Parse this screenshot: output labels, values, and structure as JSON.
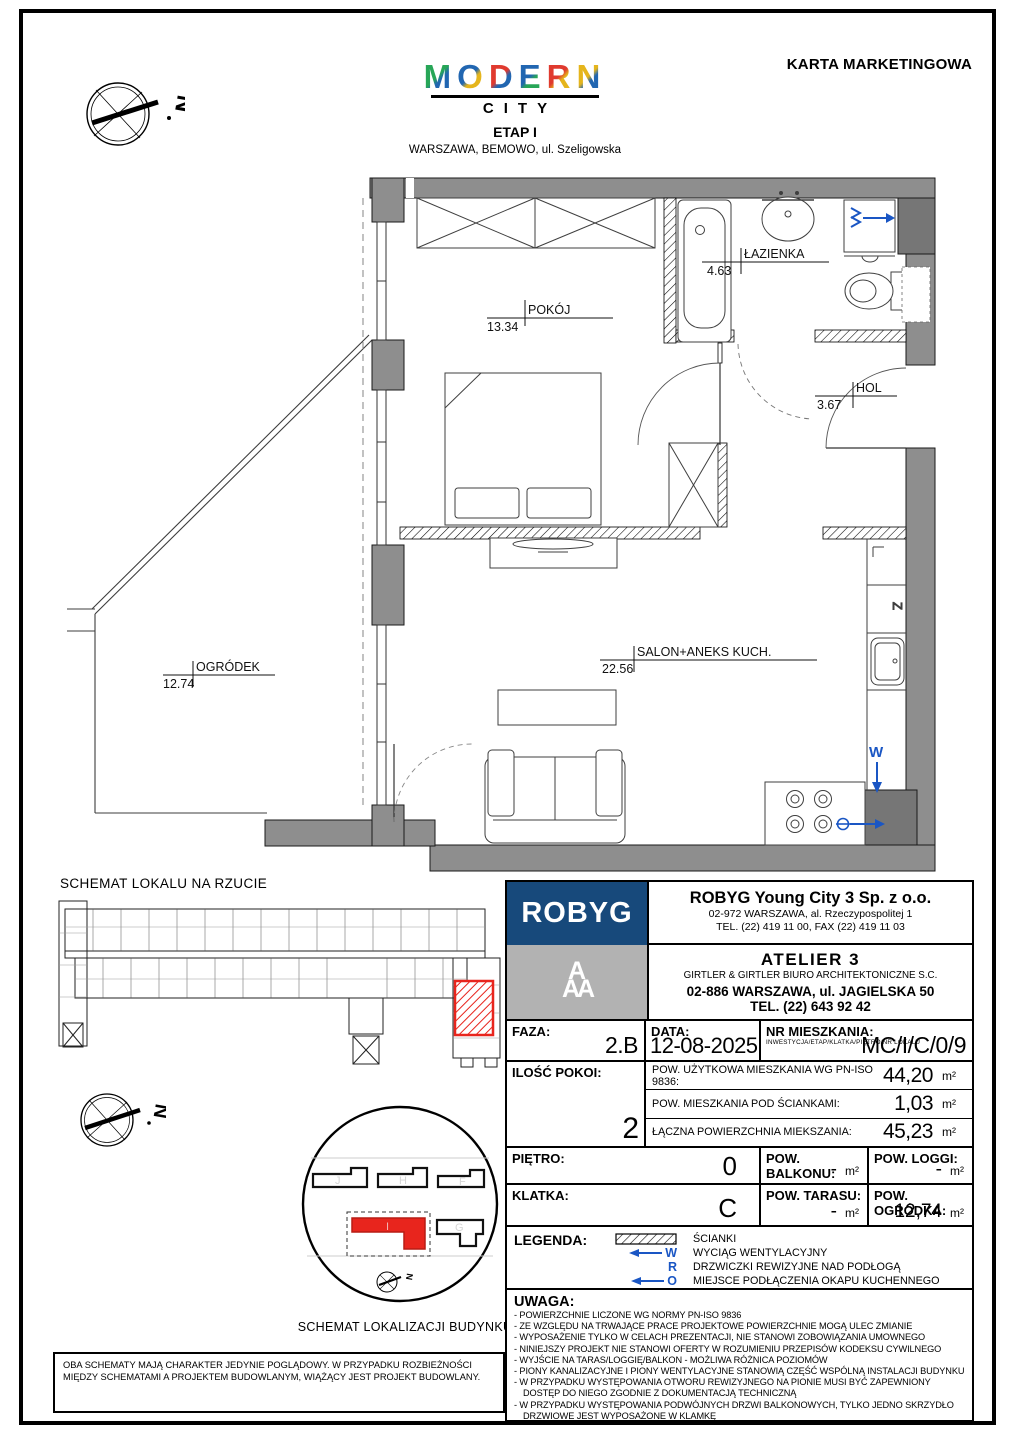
{
  "page": {
    "karta_title": "KARTA MARKETINGOWA"
  },
  "header": {
    "logo_word": "MODERN",
    "logo_sub": "CITY",
    "etap": "ETAP I",
    "address": "WARSZAWA, BEMOWO, ul. Szeligowska"
  },
  "plan": {
    "rooms": {
      "pokoj": {
        "name": "POKÓJ",
        "area": "13.34"
      },
      "lazienka": {
        "name": "ŁAZIENKA",
        "area": "4.63"
      },
      "hol": {
        "name": "HOL",
        "area": "3.67"
      },
      "salon": {
        "name": "SALON+ANEKS KUCH.",
        "area": "22.56"
      },
      "ogrodek": {
        "name": "OGRÓDEK",
        "area": "12.74"
      }
    },
    "symbols": {
      "vent": "W",
      "hood": "O",
      "dishwasher": "Z",
      "fridge": "L",
      "north": "N"
    }
  },
  "schemat_lokalu": {
    "title": "SCHEMAT LOKALU NA RZUCIE"
  },
  "schemat_lokalizacji": {
    "title": "SCHEMAT LOKALIZACJI BUDYNKU",
    "buildings": [
      "J",
      "H",
      "F",
      "I",
      "G"
    ]
  },
  "developer": {
    "logo": "ROBYG",
    "logo_aaa": "A",
    "company": "ROBYG Young City 3 Sp. z o.o.",
    "address": "02-972 WARSZAWA, al. Rzeczypospolitej 1",
    "phone": "TEL. (22) 419 11 00, FAX (22) 419 11 03"
  },
  "architect": {
    "name": "ATELIER 3",
    "studio": "GIRTLER & GIRTLER BIURO ARCHITEKTONICZNE S.C.",
    "address": "02-886 WARSZAWA, ul. JAGIELSKA 50",
    "phone": "TEL. (22) 643 92 42"
  },
  "table": {
    "faza": {
      "label": "FAZA:",
      "value": "2.B"
    },
    "data": {
      "label": "DATA:",
      "value": "12-08-2025"
    },
    "nr": {
      "label": "NR MIESZKANIA:",
      "sub": "INWESTYCJA/ETAP/KLATKA/PIĘTRO/NR LOKALU",
      "value": "MC/I/C/0/9"
    },
    "pokoi": {
      "label": "ILOŚĆ POKOI:",
      "value": "2"
    },
    "areas": [
      {
        "label": "POW. UŻYTKOWA MIESZKANIA WG PN-ISO 9836:",
        "value": "44,20",
        "unit": "m²"
      },
      {
        "label": "POW. MIESZKANIA POD ŚCIANKAMI:",
        "value": "1,03",
        "unit": "m²"
      },
      {
        "label": "ŁĄCZNA POWIERZCHNIA MIEKSZANIA:",
        "value": "45,23",
        "unit": "m²"
      }
    ],
    "pietro": {
      "label": "PIĘTRO:",
      "value": "0"
    },
    "balkon": {
      "label": "POW. BALKONU:",
      "value": "-",
      "unit": "m²"
    },
    "loggi": {
      "label": "POW. LOGGI:",
      "value": "-",
      "unit": "m²"
    },
    "klatka": {
      "label": "KLATKA:",
      "value": "C"
    },
    "taras": {
      "label": "POW. TARASU:",
      "value": "-",
      "unit": "m²"
    },
    "ogrodek_pow": {
      "label": "POW. OGRÓDKA:",
      "value": "12,74",
      "unit": "m²"
    }
  },
  "legenda": {
    "title": "LEGENDA:",
    "items": [
      {
        "symbol": "hatch",
        "text": "ŚCIANKI"
      },
      {
        "symbol": "W",
        "text": "WYCIĄG WENTYLACYJNY"
      },
      {
        "symbol": "R",
        "text": "DRZWICZKI REWIZYJNE NAD PODŁOGĄ"
      },
      {
        "symbol": "O",
        "text": "MIEJSCE PODŁĄCZENIA OKAPU KUCHENNEGO"
      }
    ]
  },
  "uwaga": {
    "title": "UWAGA:",
    "notes": [
      "- POWIERZCHNIE LICZONE WG NORMY PN-ISO 9836",
      "- ZE WZGLĘDU NA TRWAJĄCE PRACE PROJEKTOWE POWIERZCHNIE MOGĄ ULEC ZMIANIE",
      "- WYPOSAŻENIE TYLKO W CELACH PREZENTACJI, NIE STANOWI ZOBOWIĄZANIA UMOWNEGO",
      "- NINIEJSZY PROJEKT NIE STANOWI OFERTY W ROZUMIENIU PRZEPISÓW KODEKSU CYWILNEGO",
      "- WYJŚCIE NA TARAS/LOGGIĘ/BALKON - MOŻLIWA RÓŻNICA POZIOMÓW",
      "- PIONY KANALIZACYJNE I PIONY WENTYLACYJNE STANOWIĄ CZĘŚĆ WSPÓLNĄ INSTALACJI BUDYNKU",
      "- W PRZYPADKU WYSTĘPOWANIA OTWORU REWIZYJNEGO NA PIONIE MUSI BYĆ ZAPEWNIONY DOSTĘP DO NIEGO ZGODNIE Z DOKUMENTACJĄ TECHNICZNĄ",
      "- W PRZYPADKU WYSTĘPOWANIA PODWÓJNYCH DRZWI BALKONOWYCH, TYLKO JEDNO SKRZYDŁO DRZWIOWE JEST WYPOSAŻONE W KLAMKĘ"
    ]
  },
  "footer": {
    "text": "OBA SCHEMATY MAJĄ CHARAKTER JEDYNIE POGLĄDOWY. W PRZYPADKU ROZBIEŻNOŚCI MIĘDZY SCHEMATAMI A PROJEKTEM BUDOWLANYM, WIĄŻĄCY JEST PROJEKT BUDOWLANY."
  },
  "colors": {
    "robyg_navy": "#17497B",
    "logo_gray": "#B2B2B2",
    "wall_gray": "#8E8E8E",
    "unit_red": "#E8251D",
    "plan_blue": "#1A56C4"
  }
}
